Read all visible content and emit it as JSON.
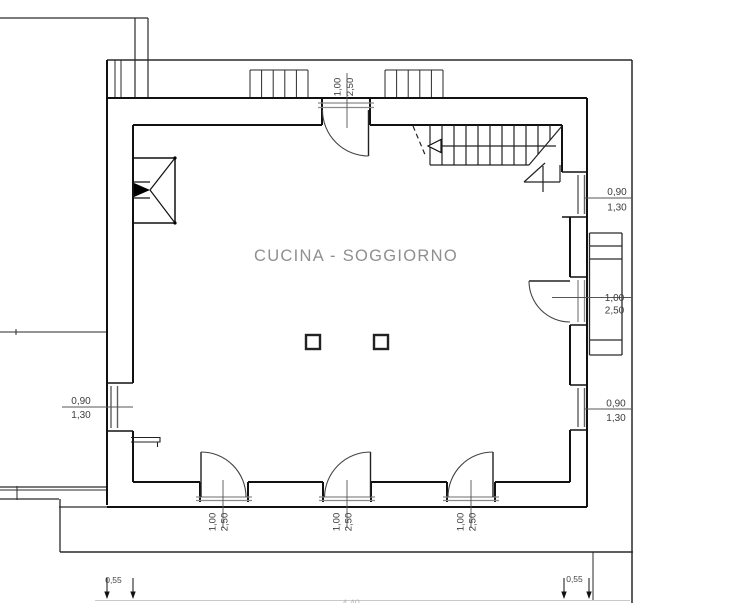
{
  "drawing": {
    "type": "architectural-floor-plan",
    "room": {
      "label": "CUCINA - SOGGIORNO"
    },
    "colors": {
      "wall_line": "#1a1a1a",
      "context_line": "#333333",
      "dimension_line": "#666666",
      "threshold_gray": "#8a8a8a",
      "label_gray": "#8f8f8f",
      "faint_line": "#c9c9c9"
    },
    "dimensions": [
      {
        "id": "door-top",
        "element": "door",
        "lines": [
          "1,00",
          "2,50"
        ]
      },
      {
        "id": "window-right-top",
        "element": "window",
        "lines": [
          "0,90",
          "1,30"
        ]
      },
      {
        "id": "door-right",
        "element": "door",
        "lines": [
          "1,00",
          "2,50"
        ]
      },
      {
        "id": "window-right-bottom",
        "element": "window",
        "lines": [
          "0,90",
          "1,30"
        ]
      },
      {
        "id": "window-left",
        "element": "window",
        "lines": [
          "0,90",
          "1,30"
        ]
      },
      {
        "id": "door-bottom-left",
        "element": "door",
        "lines": [
          "1,00",
          "2,50"
        ]
      },
      {
        "id": "door-bottom-middle",
        "element": "door",
        "lines": [
          "1,00",
          "2,50"
        ]
      },
      {
        "id": "door-bottom-right",
        "element": "door",
        "lines": [
          "1,00",
          "2,50"
        ]
      },
      {
        "id": "wall-thickness-left",
        "element": "wall",
        "lines": [
          "0,55"
        ]
      },
      {
        "id": "wall-thickness-right",
        "element": "wall",
        "lines": [
          "0,55"
        ]
      },
      {
        "id": "overall-width",
        "element": "plan",
        "lines": [
          "4,40"
        ]
      }
    ]
  }
}
